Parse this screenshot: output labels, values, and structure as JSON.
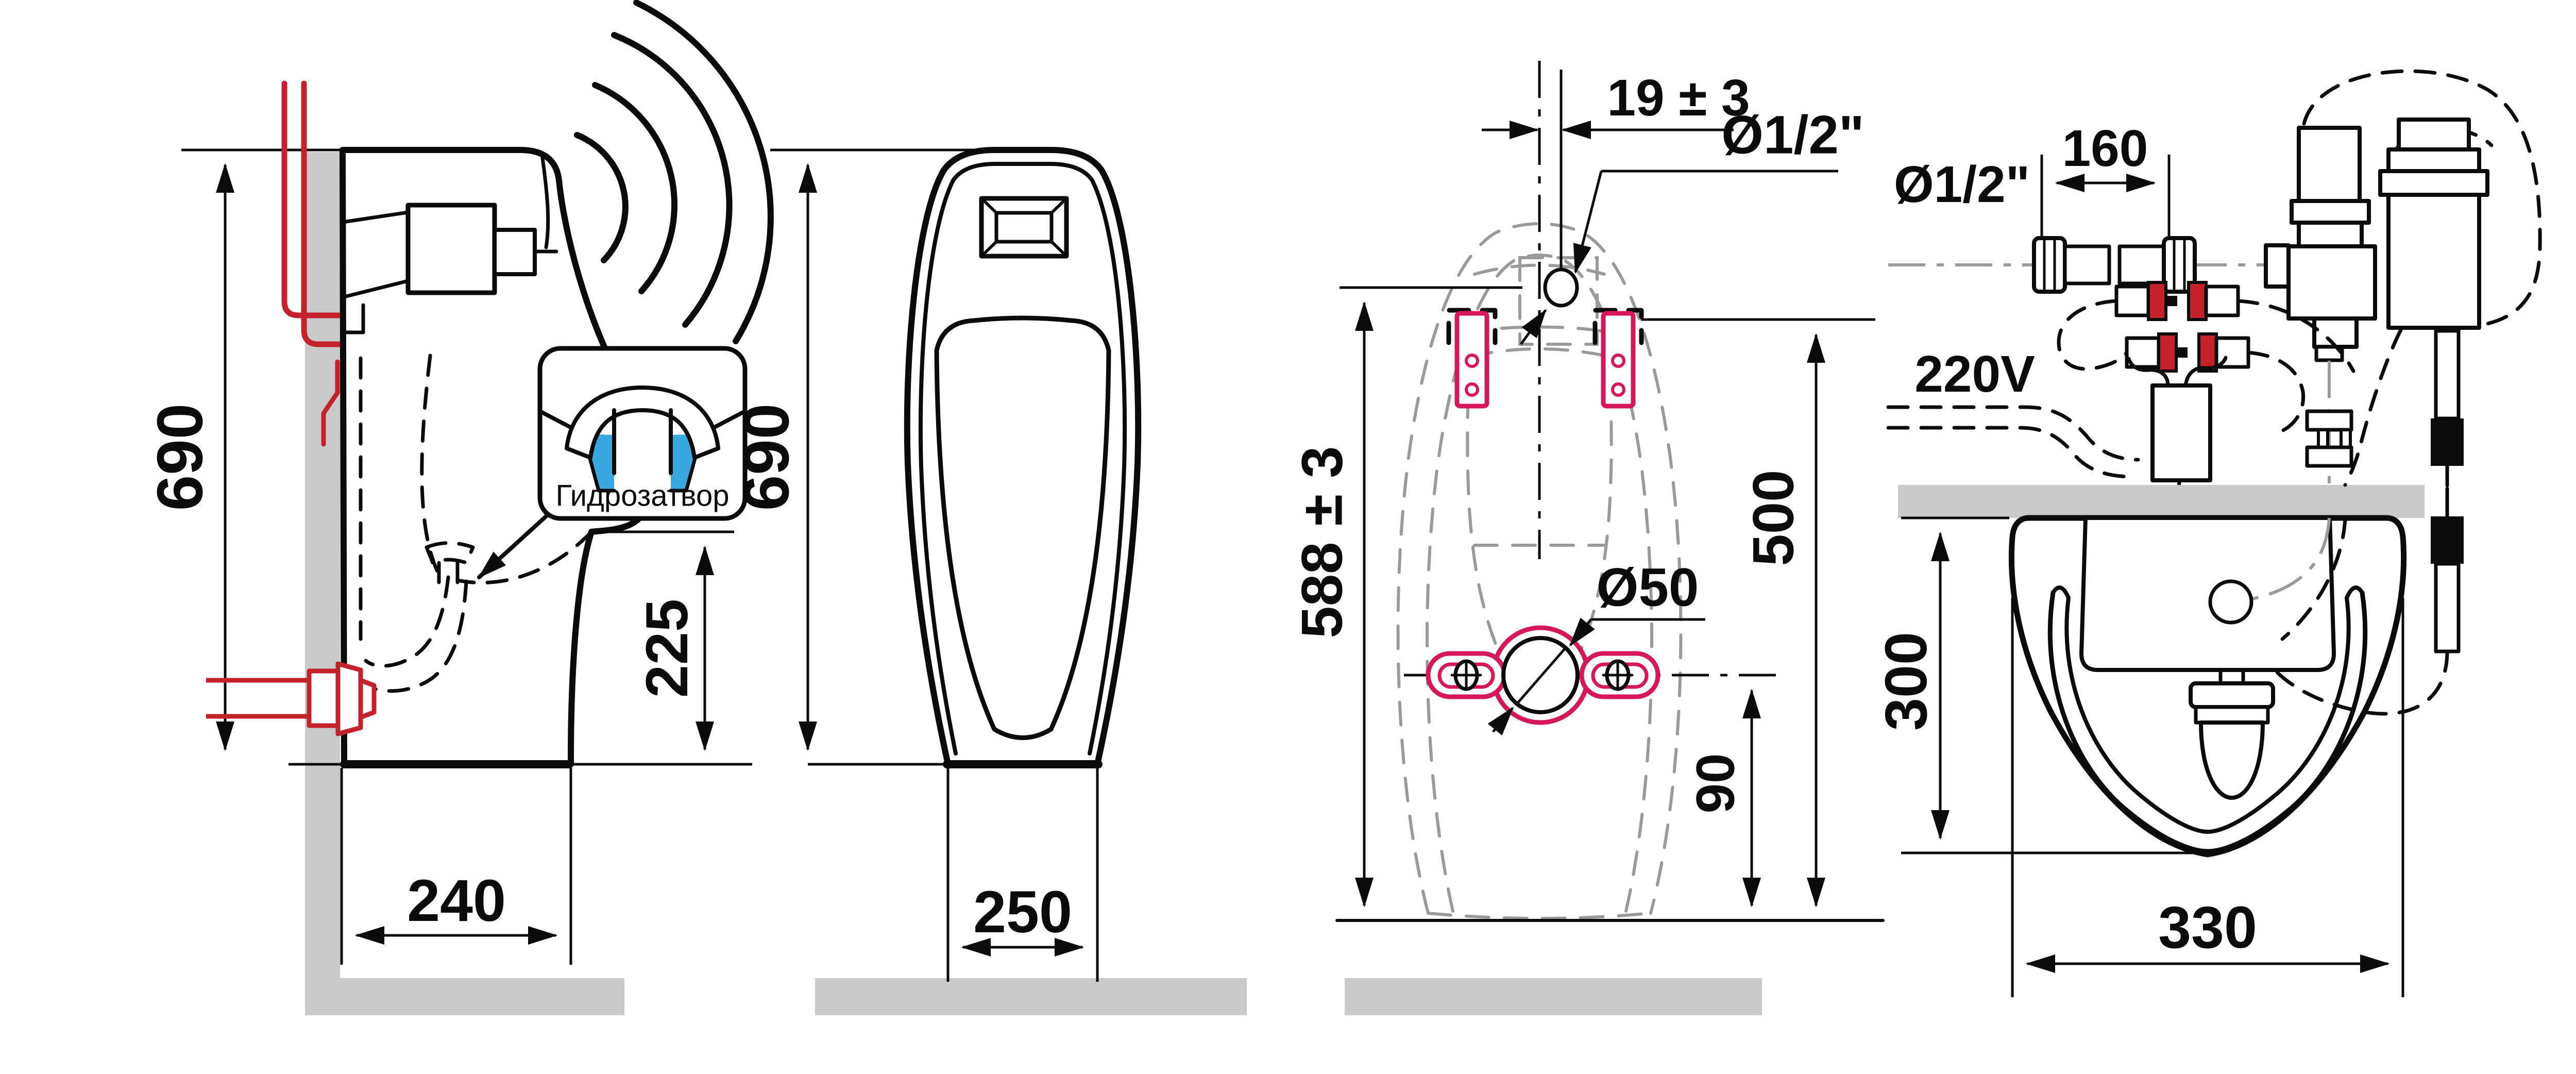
{
  "meta": {
    "background": "#ffffff",
    "ink": "#0b0b0b",
    "wall_gray": "#c9c9c9",
    "hidden_outline_gray": "#9a9a9a",
    "pipe_red": "#c5212b",
    "bracket_pink": "#d6185b",
    "water_blue": "#3aa8e0"
  },
  "panels": {
    "side_view": {
      "height_label": "690",
      "spout_height_label": "225",
      "depth_label": "240",
      "callout_label": "Гидрозатвор"
    },
    "front_view": {
      "height_label": "690",
      "width_label": "250"
    },
    "rear_view": {
      "offset_label": "19 ± 3",
      "inlet_label": "Ø1/2\"",
      "height_label": "588 ± 3",
      "bracket_height_label": "500",
      "drain_label": "Ø50",
      "drain_height_label": "90"
    },
    "install_view": {
      "inlet_label": "Ø1/2\"",
      "hose_length_label": "160",
      "power_label": "220V",
      "depth_label": "300",
      "width_label": "330"
    }
  }
}
